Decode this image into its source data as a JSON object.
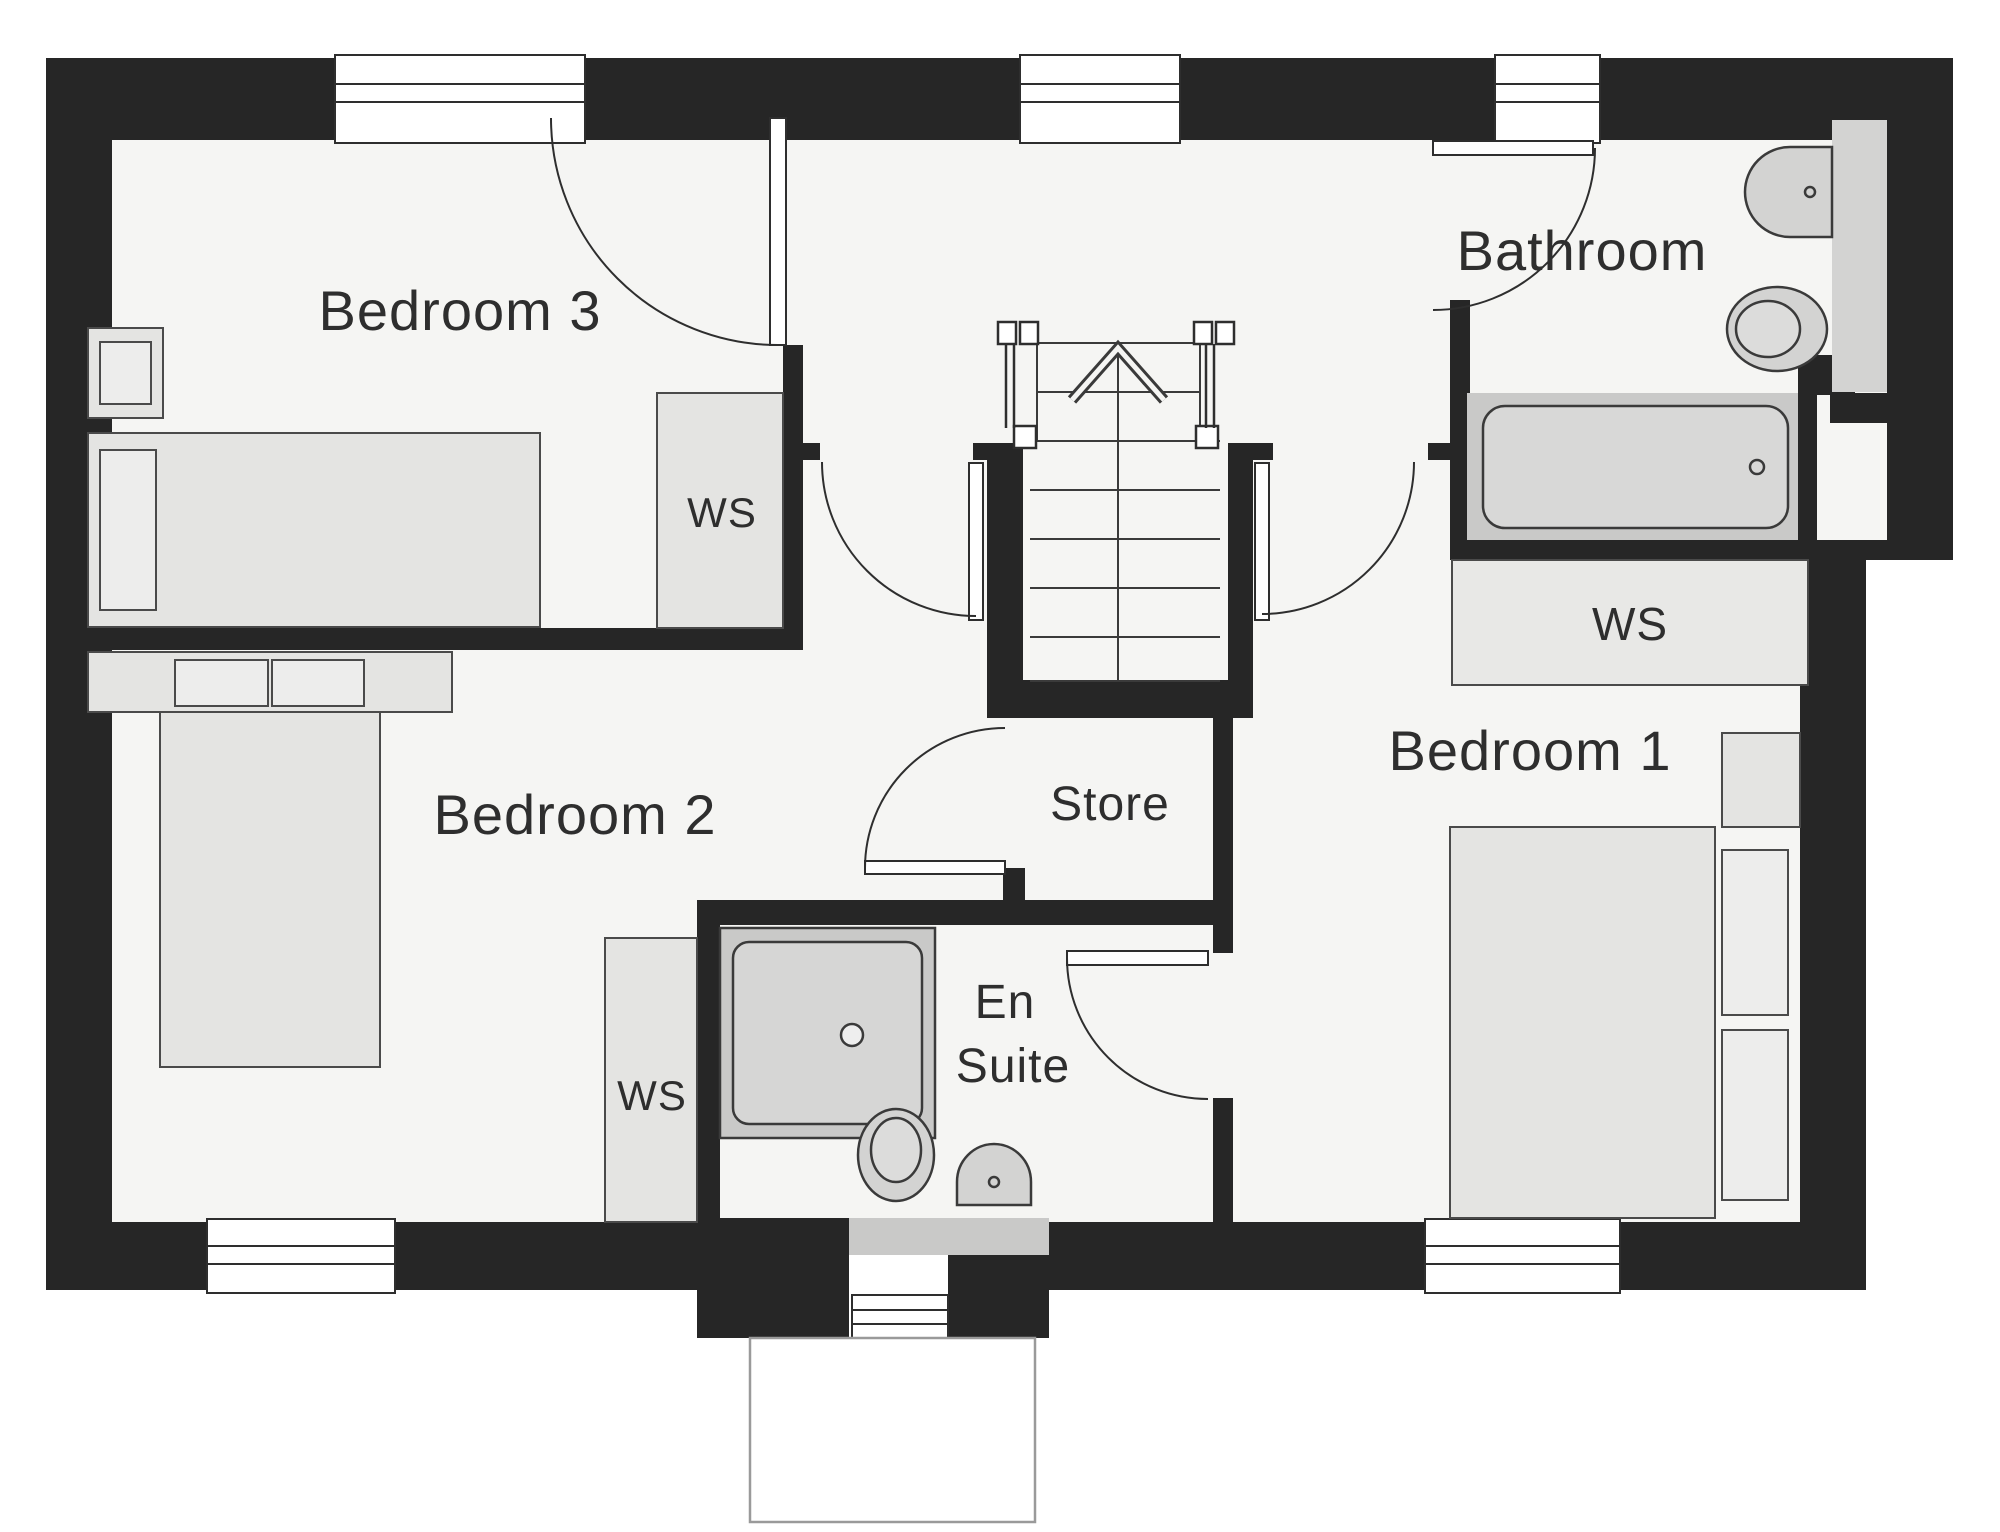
{
  "plan": {
    "type": "floor-plan",
    "rooms": {
      "bedroom3": {
        "label": "Bedroom 3"
      },
      "bedroom2": {
        "label": "Bedroom 2"
      },
      "bedroom1": {
        "label": "Bedroom 1"
      },
      "bathroom": {
        "label": "Bathroom"
      },
      "store": {
        "label": "Store"
      },
      "ensuite": {
        "label_line1": "En",
        "label_line2": "Suite"
      },
      "wardrobe": {
        "label": "WS"
      }
    },
    "features": [
      "staircase-up",
      "bath",
      "shower",
      "toilet-x2",
      "basin-x2",
      "double-bed-x2",
      "single-bed",
      "wardrobe-space-x3"
    ],
    "colors": {
      "wall": "#262626",
      "room_fill": "#f5f5f3",
      "furniture": "#e4e4e2",
      "fixture": "#d3d3d2",
      "floor_strip": "#c9c9c8",
      "label": "#2e2e2e"
    }
  }
}
